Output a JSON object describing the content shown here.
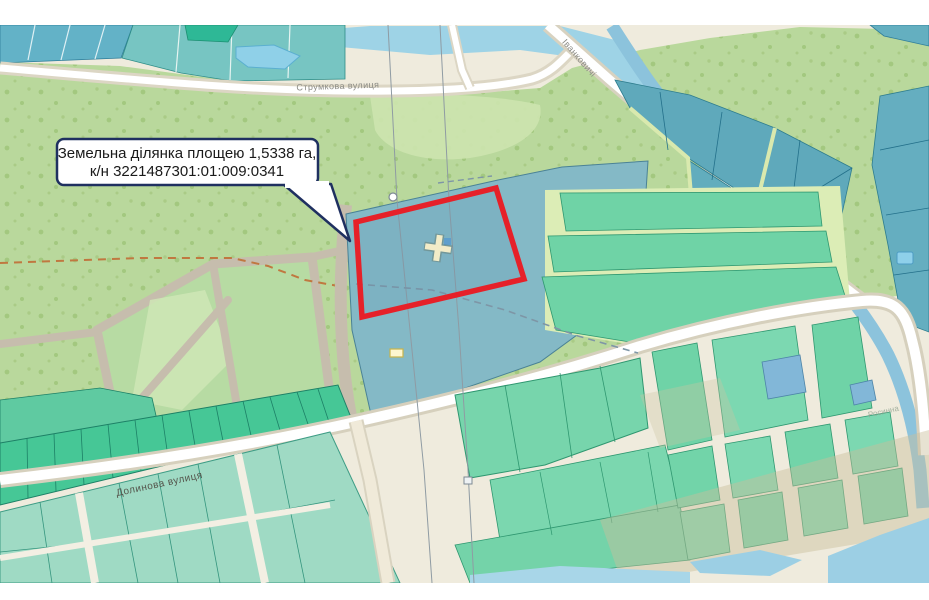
{
  "callout": {
    "line1": "Земельна ділянка площею 1,5338 га,",
    "line2": "к/н 3221487301:01:009:0341"
  },
  "streets": {
    "strumkova": "Струмкова вулиця",
    "dolynova": "Долинова вулиця",
    "ivankovychi": "Іванковичі",
    "rosynna": "Росинна"
  },
  "parcel": {
    "area_ha": "1,5338",
    "cadastral_number": "3221487301:01:009:0341",
    "center_marker_symbol": "+"
  },
  "colors": {
    "selection_red": "#e62129",
    "callout_border": "#1f3060",
    "forest_green": "#b9d89c",
    "parcel_teal": "#84b9c6",
    "parcel_green": "#6fd3a7",
    "water_blue": "#9ed3e6",
    "road_cream": "#efebdd"
  }
}
